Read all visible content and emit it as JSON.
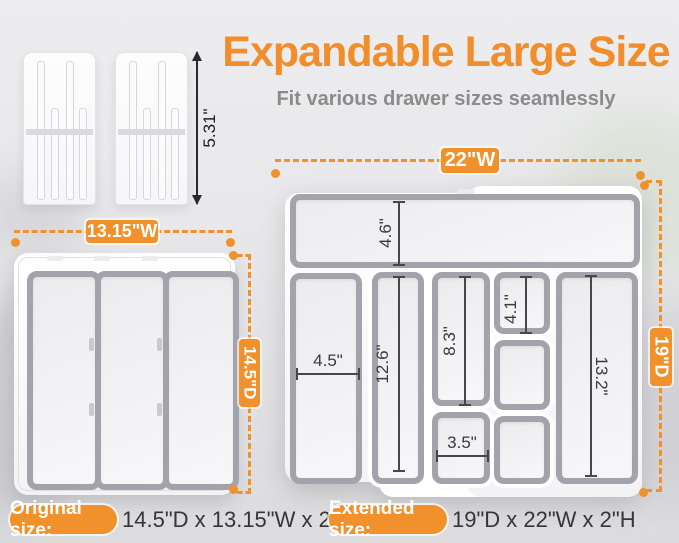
{
  "header": {
    "title": "Expandable Large Size",
    "subtitle": "Fit various drawer sizes seamlessly"
  },
  "colors": {
    "accent_orange": "#F0912C",
    "title_orange": "#F18E2B",
    "subtitle_gray": "#8B8B8B",
    "dimension_text": "#3A3A3E",
    "tray_border_gray": "#A3A3AC"
  },
  "divider": {
    "height_label": "5.31\""
  },
  "compact_tray": {
    "width_label": "13.15\"W",
    "depth_label": "14.5\"D"
  },
  "expanded_tray": {
    "width_label": "22\"W",
    "depth_label": "19\"D",
    "measurements": {
      "top_compartment_depth": "4.6\"",
      "left_compartment_width": "4.5\"",
      "second_column_length": "12.6\"",
      "third_column_upper_length": "8.3\"",
      "third_column_lower_width": "3.5\"",
      "fourth_column_upper_length": "4.1\"",
      "right_compartment_length": "13.2\""
    }
  },
  "footer": {
    "original": {
      "label": "Original size:",
      "value": "14.5\"D x 13.15\"W x 2\"H"
    },
    "extended": {
      "label": "Extended size:",
      "value": "19\"D x 22\"W x 2\"H"
    }
  }
}
